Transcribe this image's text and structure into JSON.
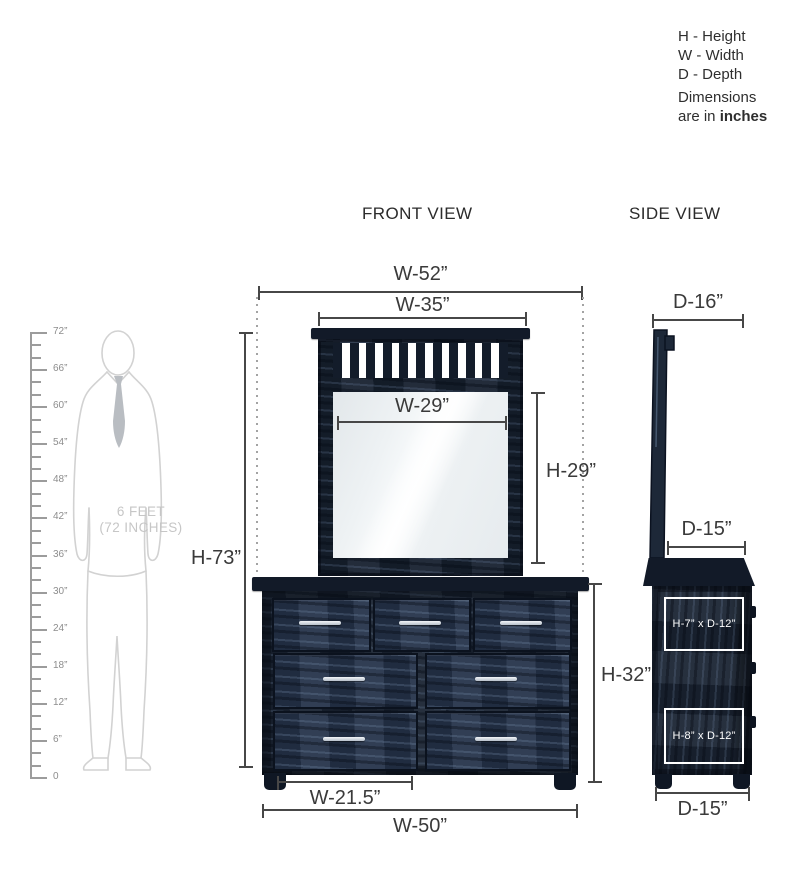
{
  "legend": {
    "items": [
      "H - Height",
      "W - Width",
      "D - Depth"
    ],
    "note_line1": "Dimensions",
    "note_line2_normal": "are in ",
    "note_line2_bold": "inches"
  },
  "view_titles": {
    "front": "FRONT VIEW",
    "side": "SIDE VIEW"
  },
  "scale_figure": {
    "caption_line1": "6 FEET",
    "caption_line2": "(72 INCHES)",
    "ruler": {
      "unit": "inches",
      "max": 72,
      "major_step": 6,
      "minor_step": 2,
      "labels_top_to_bottom": [
        "72”",
        "66”",
        "60”",
        "54”",
        "48”",
        "42”",
        "36”",
        "30”",
        "24”",
        "18”",
        "12”",
        "6”",
        "0"
      ]
    }
  },
  "front_view": {
    "dimensions": {
      "overall_width": "W-52”",
      "mirror_width": "W-35”",
      "glass_width": "W-29”",
      "glass_height": "H-29”",
      "overall_height": "H-73”",
      "dresser_height": "H-32”",
      "drawer_width": "W-21.5”",
      "dresser_width": "W-50”"
    },
    "mirror": {
      "slat_count": 11
    },
    "drawer_rows": [
      3,
      2,
      2
    ]
  },
  "side_view": {
    "dimensions": {
      "mirror_depth": "D-16”",
      "top_depth": "D-15”",
      "base_depth": "D-15”",
      "upper_drawer_box": "H-7” x D-12”",
      "lower_drawer_box": "H-8” x D-12”"
    }
  },
  "colors": {
    "furniture_navy": "#202c3e",
    "furniture_dark": "#121a28",
    "handle_silver": "#d9dee3",
    "dimension_line": "#474747",
    "figure_outline": "#d2d2d2",
    "ruler_gray": "#9c9c9c",
    "annotation_white": "#ffffff"
  }
}
